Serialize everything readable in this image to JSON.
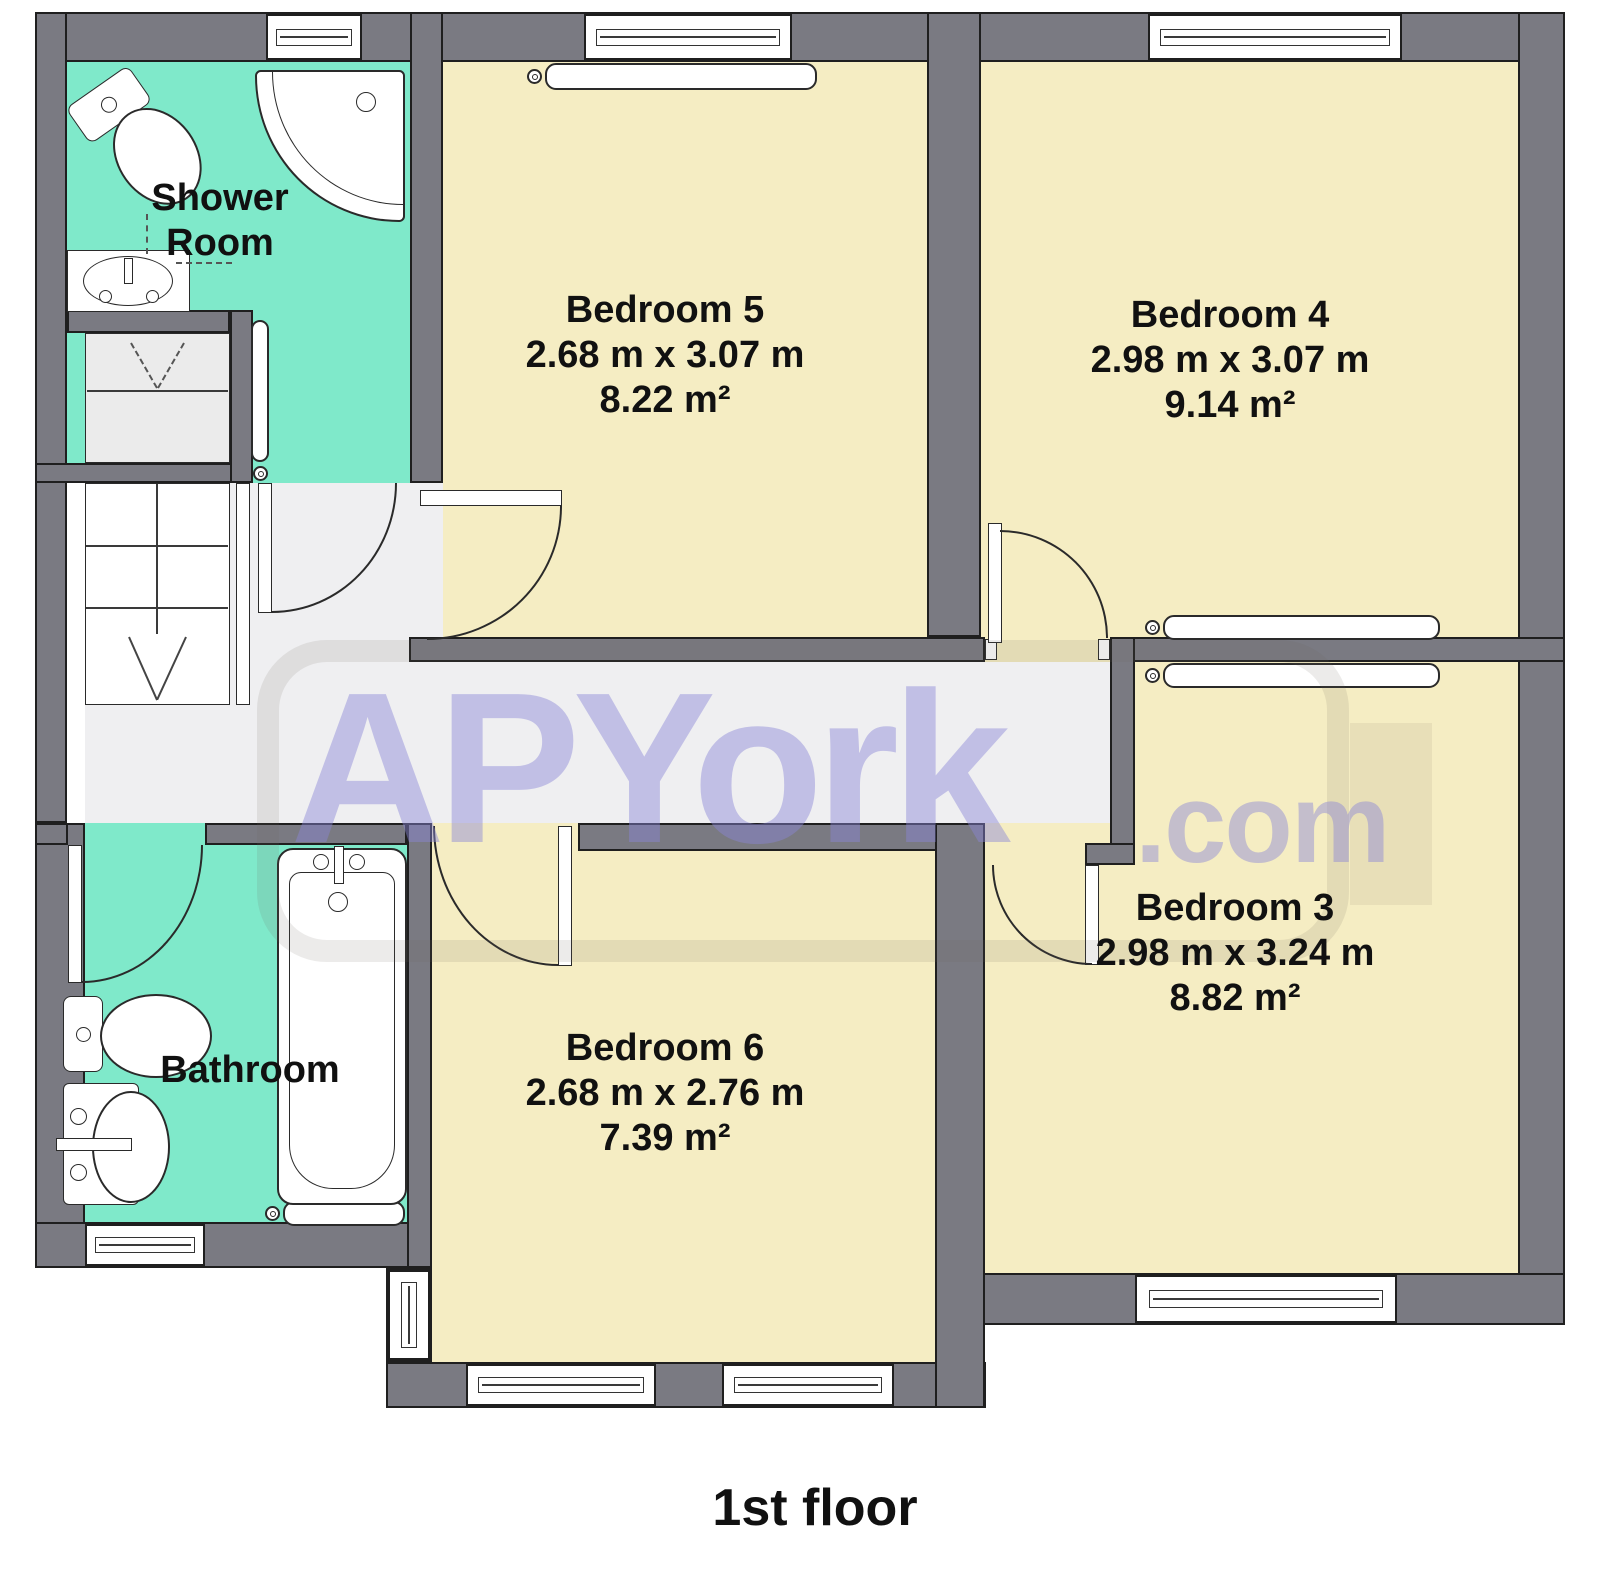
{
  "title": "1st floor",
  "watermark": {
    "brand": "APYork",
    "suffix": ".com"
  },
  "rooms": {
    "shower_room": {
      "name": "Shower Room"
    },
    "bedroom5": {
      "name": "Bedroom 5",
      "dimensions": "2.68 m x 3.07 m",
      "area": "8.22 m²"
    },
    "bedroom4": {
      "name": "Bedroom 4",
      "dimensions": "2.98 m x 3.07 m",
      "area": "9.14 m²"
    },
    "bedroom3": {
      "name": "Bedroom 3",
      "dimensions": "2.98 m x 3.24 m",
      "area": "8.82 m²"
    },
    "bedroom6": {
      "name": "Bedroom 6",
      "dimensions": "2.68 m x 2.76 m",
      "area": "7.39 m²"
    },
    "bathroom": {
      "name": "Bathroom"
    }
  },
  "colors": {
    "wall": "#7a7a82",
    "outline": "#1f1f1f",
    "bedroom_floor": "#f5edc3",
    "wet_room_floor": "#7fe9ca",
    "hallway_floor": "#efeff1",
    "chimney_breast": "#e8dfb8",
    "watermark": "#8a86d8"
  }
}
